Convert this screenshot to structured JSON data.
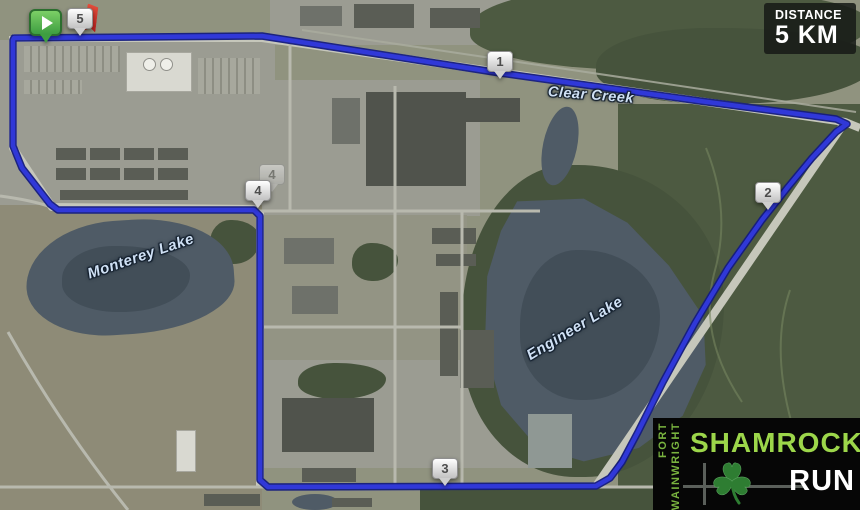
{
  "distance_badge": {
    "label": "DISTANCE",
    "value": "5 KM"
  },
  "map": {
    "place_labels": [
      {
        "name": "Clear Creek"
      },
      {
        "name": "Monterey Lake"
      },
      {
        "name": "Engineer Lake"
      }
    ],
    "km_markers": [
      {
        "number": "1"
      },
      {
        "number": "2"
      },
      {
        "number": "3"
      },
      {
        "number": "4"
      },
      {
        "number": "5"
      }
    ],
    "icons": {
      "start": "play-icon",
      "finish": "flag-icon"
    }
  },
  "logo": {
    "location_line1": "FORT",
    "location_line2": "WAINWRIGHT",
    "title": "SHAMROCK",
    "subtitle": "RUN"
  },
  "colors": {
    "route_blue": "#3038d8",
    "route_casing": "#141b7e",
    "start_green": "#3e9e41",
    "finish_flag_red": "#c62828",
    "logo_green": "#9cd64a",
    "badge_background": "#161a16",
    "lake_blue": "#4f5b66"
  }
}
